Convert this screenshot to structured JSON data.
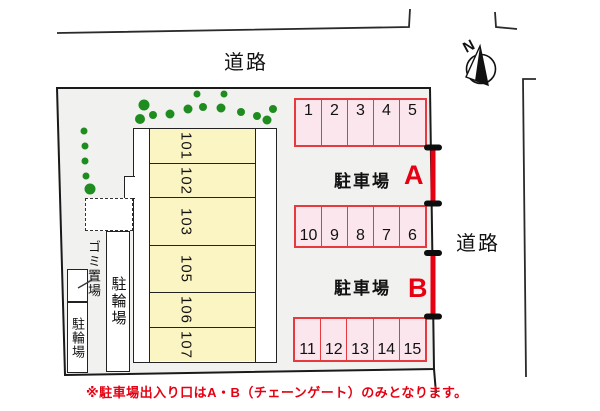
{
  "roads": {
    "top_label": "道路",
    "right_label": "道路"
  },
  "compass": {
    "label": "N"
  },
  "building": {
    "units": [
      "101",
      "102",
      "103",
      "105",
      "106",
      "107"
    ]
  },
  "parking": {
    "area_a": {
      "label": "駐車場",
      "gate": "A"
    },
    "area_b": {
      "label": "駐車場",
      "gate": "B"
    },
    "rows": [
      {
        "spaces": [
          "1",
          "2",
          "3",
          "4",
          "5"
        ]
      },
      {
        "spaces": [
          "10",
          "9",
          "8",
          "7",
          "6"
        ]
      },
      {
        "spaces": [
          "11",
          "12",
          "13",
          "14",
          "15"
        ]
      }
    ]
  },
  "facilities": {
    "garbage": "ゴミ置場",
    "bicycle_main": "駐輪場",
    "bicycle_sub": "駐輪場"
  },
  "note": "※駐車場出入り口はA・B（チェーンゲート）のみとなります。",
  "colors": {
    "site_fill": "#f1f1f0",
    "unit_fill": "#fbf5c4",
    "stall_fill": "#fce6ee",
    "stall_border": "#e63a3f",
    "accent_red": "#e60012",
    "tree_green": "#1e8c1e"
  }
}
